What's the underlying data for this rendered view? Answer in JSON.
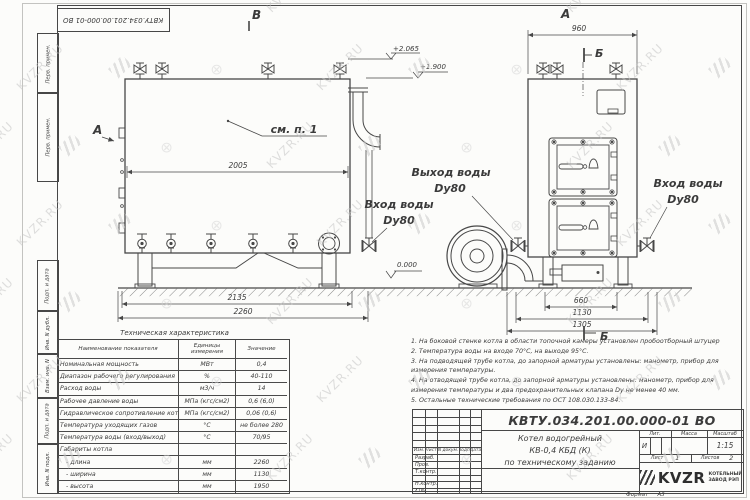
{
  "watermark": {
    "text": "KVZR.RU",
    "cross": "⊕"
  },
  "margin": {
    "doc_number_top": "КВТУ.034.201.00.000-01 ВО",
    "boxes": [
      "Перв. примен.",
      "Перв. примен.",
      "Подп. и дата",
      "Инв. N дубл.",
      "Взам. инв. N",
      "Подп. и дата",
      "Инв. N подл."
    ]
  },
  "drawing": {
    "view_b_label": "В",
    "section_a_label": "А",
    "callout": "см. п. 1",
    "dim_2005": "2005",
    "dim_2135": "2135",
    "dim_2260": "2260",
    "elev_2065": "+2.065",
    "elev_1900": "+1.900",
    "elev_zero": "0.000",
    "left_inlet_line1": "Вход воды",
    "left_inlet_line2": "Dy80",
    "right_view_label": "А",
    "dim_960": "960",
    "section_top": "Б",
    "section_bottom": "Б",
    "outlet_line1": "Выход воды",
    "outlet_line2": "Dy80",
    "right_inlet_line1": "Вход воды",
    "right_inlet_line2": "Dy80",
    "dim_660": "660",
    "dim_1130": "1130",
    "dim_1305": "1305"
  },
  "spec_table": {
    "title": "Техническая характеристика",
    "headers": [
      "Наименование показателя",
      "Единицы измерения",
      "Значение"
    ],
    "rows": [
      {
        "name": "Номинальная мощность",
        "unit": "МВт",
        "value": "0,4"
      },
      {
        "name": "Диапазон рабочего регулирования",
        "unit": "%",
        "value": "40-110"
      },
      {
        "name": "Расход воды",
        "unit": "м3/ч",
        "value": "14"
      },
      {
        "name": "Рабочее давление воды",
        "unit": "МПа (кгс/см2)",
        "value": "0,6 (6,0)"
      },
      {
        "name": "Гидравлическое сопротивление котла",
        "unit": "МПа (кгс/см2)",
        "value": "0,06 (0,6)"
      },
      {
        "name": "Температура уходящих газов",
        "unit": "°С",
        "value": "не более 280"
      },
      {
        "name": "Температура воды (вход/выход)",
        "unit": "°С",
        "value": "70/95"
      },
      {
        "name": "Габариты котла",
        "unit": "",
        "value": ""
      },
      {
        "name": "- длина",
        "unit": "мм",
        "value": "2260"
      },
      {
        "name": "- ширина",
        "unit": "мм",
        "value": "1130"
      },
      {
        "name": "- высота",
        "unit": "мм",
        "value": "1950"
      }
    ]
  },
  "notes": [
    "1.  На боковой стенке котла в области топочной камеры установлен пробоотборный штуцер",
    "2.  Температура воды на входе  70°С,  на выходе  95°С.",
    "3.  На подводящей трубе котла, до запорной арматуры установлены:  манометр,  прибор для измерения температуры.",
    "4.  На отводящей трубе котла, до запорной арматуры установлены:  манометр,  прибор для измерения температуры и два предохранительных клапана  Dу не менее  40 мм.",
    "5.  Остальные технические требования по ОСТ  108.030.133-84."
  ],
  "title_block": {
    "doc_number": "КВТУ.034.201.00.000-01 ВО",
    "title_line1": "Котел водогрейный",
    "title_line2": "КВ-0,4  КБД  (К)",
    "title_line3": "по техническому заданию",
    "col_izm": "Изм.",
    "col_list": "Лист",
    "col_ndoc": "N докум.",
    "col_podp": "Подп.",
    "col_data": "Дата",
    "role_razrab": "Разраб.",
    "role_prov": "Пров.",
    "role_tkontr": "Т.контр.",
    "role_nkontr": "Н.контр.",
    "role_utv": "Утв.",
    "lit_header": "Лит.",
    "mass_header": "Масса",
    "scale_header": "Масштаб",
    "lit_value": "И",
    "scale_value": "1:15",
    "sheet_label": "Лист",
    "sheet_value": "1",
    "sheets_label": "Листов",
    "sheets_value": "2",
    "logo_text": "KVZR",
    "logo_sub1": "КОТЕЛЬНЫЙ",
    "logo_sub2": "ЗАВОД РЭП",
    "format_label": "Формат",
    "format_value": "А3"
  }
}
